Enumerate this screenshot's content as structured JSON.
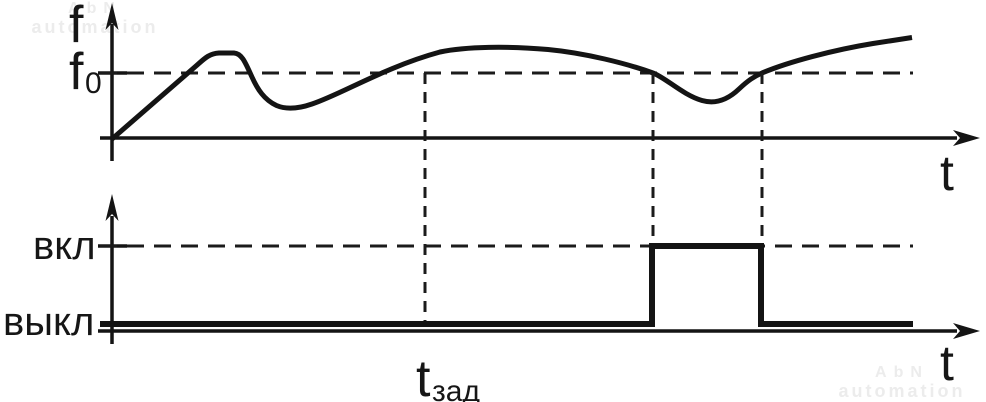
{
  "watermark": {
    "line1": "AbN",
    "line2": "automation",
    "color": "#ececec"
  },
  "top_chart": {
    "y_label": "f",
    "threshold_main": "f",
    "threshold_sub": "0",
    "x_label": "t",
    "curve_path": "M 112 139 L 196 66 C 204 59 209 53.5 219 53 L 234 53 C 242 53.5 245.5 63 251.5 76 C 257.5 89.5 264.5 100 276.5 105.5 C 287 110 299 108.5 312 104 C 342 94 385 67 440 52 C 466 46.5 508 46 548 49.5 C 585 53 627 63.5 653 73 C 666 78 683 95 702 100.5 C 716 104.5 728 99.5 739 89 C 748 80.5 754 76.5 762 73 C 788 62 833 50 873 43.5 C 889 41 903 39 912 37.5",
    "threshold_line_path": "M 100 73 H 913",
    "threshold_tick_path": "M 98 73 H 127"
  },
  "guides": {
    "delay_marker_path": "M 425 73 V 327",
    "pulse_on_path": "M 653 73 V 243",
    "pulse_off_path": "M 762 73 V 243"
  },
  "bottom_chart": {
    "on_label": "вкл",
    "off_label": "выкл",
    "x_label": "t",
    "delay_main": "t",
    "delay_sub": "зад",
    "on_level_path": "M 100 246 H 913",
    "on_tick_path": "M 98 246 H 127",
    "signal_points": "100,324 652,324 652,246 761,246 761,324 913,324"
  },
  "ink_color": "#141414",
  "chart_data": [
    {
      "type": "line",
      "title": "Frequency vs time with threshold f0",
      "ylabel": "f",
      "xlabel": "t",
      "threshold": "f0",
      "grid": false,
      "series": [
        {
          "name": "f(t)",
          "key_points_px": [
            [
              112,
              139
            ],
            [
              196,
              66
            ],
            [
              219,
              53
            ],
            [
              234,
              53
            ],
            [
              276,
              105
            ],
            [
              312,
              104
            ],
            [
              372,
              73
            ],
            [
              500,
              47
            ],
            [
              653,
              73
            ],
            [
              715,
              101
            ],
            [
              762,
              73
            ],
            [
              912,
              37
            ]
          ]
        }
      ],
      "annotations": [
        "dashed horizontal line at threshold level f0",
        "curve crosses f0 downward at x=653 and upward at x=762",
        "vertical dashed guides at x=425, x=653, x=762"
      ]
    },
    {
      "type": "line",
      "title": "Relay output (вкл/выкл) vs time",
      "ylabel_levels": [
        "вкл",
        "выкл"
      ],
      "xlabel": "t",
      "grid": false,
      "series": [
        {
          "name": "output",
          "key_points_px": [
            [
              100,
              324
            ],
            [
              652,
              324
            ],
            [
              652,
              246
            ],
            [
              761,
              246
            ],
            [
              761,
              324
            ],
            [
              913,
              324
            ]
          ]
        }
      ],
      "annotations": [
        "dashed horizontal line at вкл level",
        "output pulse ON between x=652 and x=761",
        "t_зад delay label under x=425 guide"
      ]
    }
  ]
}
